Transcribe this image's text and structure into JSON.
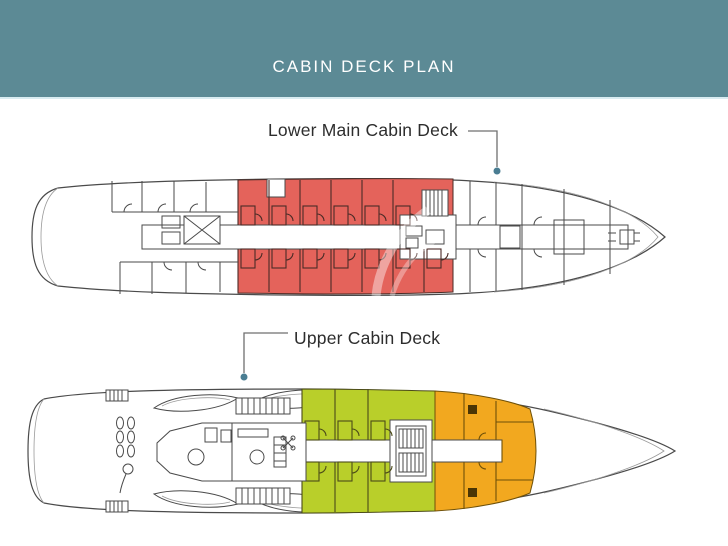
{
  "header": {
    "title": "CABIN DECK PLAN"
  },
  "decks": {
    "lower": {
      "label": "Lower Main Cabin Deck",
      "highlight": "cabin_red"
    },
    "upper": {
      "label": "Upper Cabin Deck",
      "highlights": [
        "cabin_green",
        "cabin_orange"
      ]
    }
  },
  "colors": {
    "header_bg": "#5c8a95",
    "header_edge": "#d9ecf1",
    "title_text": "#ffffff",
    "label_text": "#2d2d2d",
    "line": "#4a4a4a",
    "line_light": "#9a9a9a",
    "leader": "#6f6f6f",
    "leader_dot": "#4a7d92",
    "cabin_red": "#e4635b",
    "cabin_red_wall": "#4a2b26",
    "cabin_green": "#b9cf2a",
    "cabin_orange": "#f2a81f",
    "cabin_square": "#4a3505",
    "watermark": "#ffffff"
  }
}
